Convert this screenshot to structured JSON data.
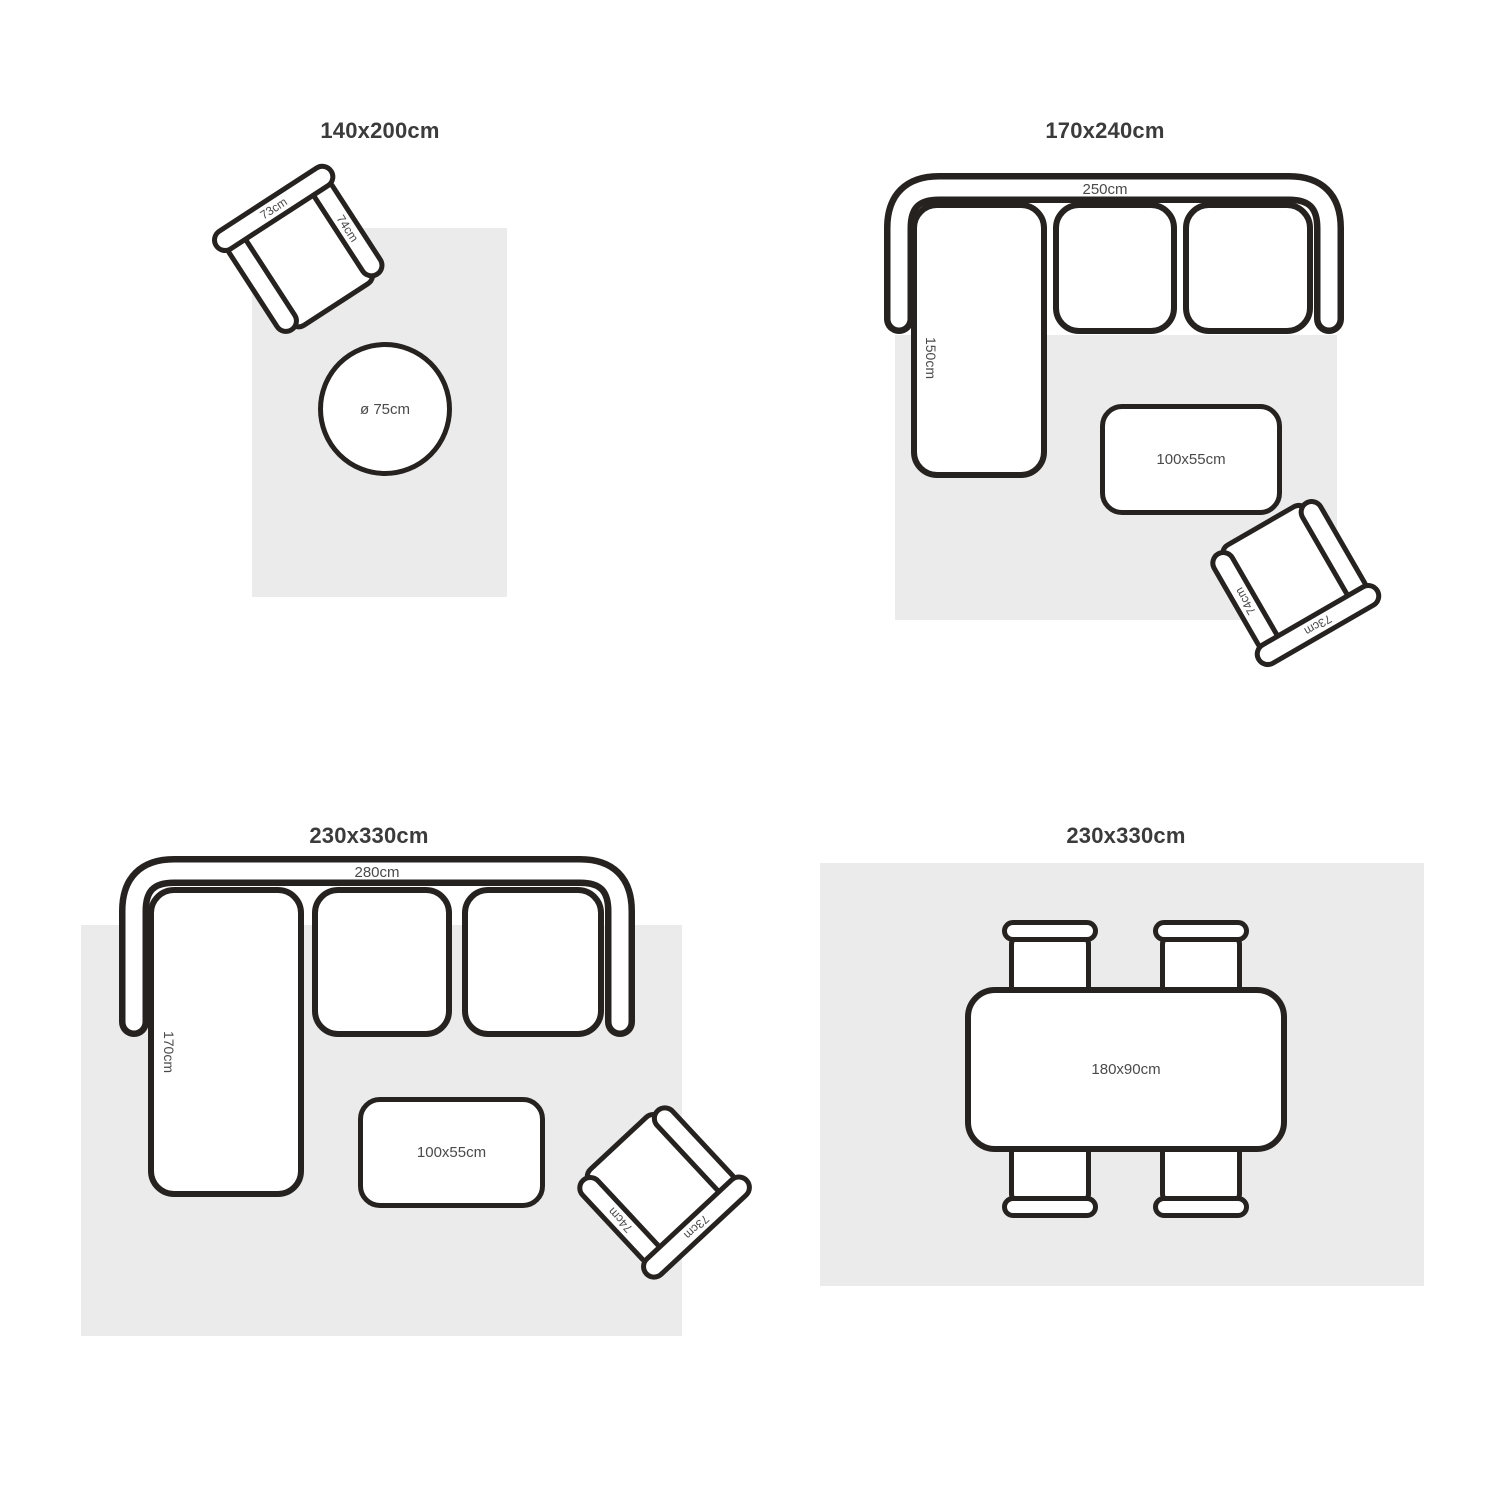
{
  "colors": {
    "outline": "#262220",
    "rug": "#ebebeb",
    "title_text": "#3b3b3b",
    "label_text": "#4a4a4a"
  },
  "quadrants": [
    {
      "title": "140x200cm",
      "armchair": {
        "back_label": "73cm",
        "arm_label": "74cm"
      },
      "round_table_label": "ø 75cm"
    },
    {
      "title": "170x240cm",
      "sofa": {
        "width_label": "250cm",
        "chaise_label": "150cm"
      },
      "coffee_table_label": "100x55cm",
      "armchair": {
        "back_label": "73cm",
        "arm_label": "74cm"
      }
    },
    {
      "title": "230x330cm",
      "sofa": {
        "width_label": "280cm",
        "chaise_label": "170cm"
      },
      "coffee_table_label": "100x55cm",
      "armchair": {
        "back_label": "73cm",
        "arm_label": "74cm"
      }
    },
    {
      "title": "230x330cm",
      "dining_table_label": "180x90cm"
    }
  ]
}
